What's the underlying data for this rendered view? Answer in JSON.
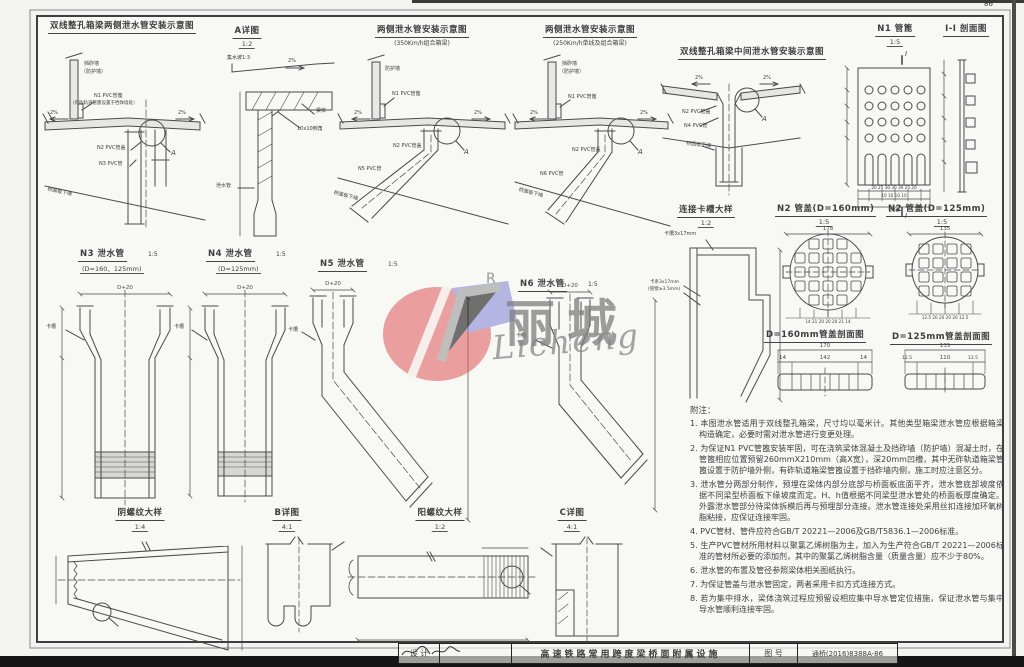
{
  "page": {
    "number": "86"
  },
  "common": {
    "slope": "2%",
    "detail_a": "A",
    "cover_label": "N2 PVC管盖",
    "grate_label": "N1 PVC管篦",
    "soffit_label": "桥面板下缘",
    "notch_label": "卡槽",
    "dim_d20": "D+20",
    "section_i": "I"
  },
  "figures": {
    "f1": {
      "title": "双线整孔箱梁两侧泄水管安装示意图",
      "wall1": "挡砟墙",
      "wall2": "（防护墙）",
      "grate_note": "（有砟轨道管篦设置于挡砟墙处）",
      "pipe": "N3 PVC管"
    },
    "f2": {
      "title": "A详图",
      "scale": "1:2",
      "slope_note": "集水坡1:3",
      "body": "梁体",
      "chamfer": "10x10倒角",
      "pipe": "泄水管"
    },
    "f3": {
      "title": "两侧泄水管安装示意图",
      "subtitle": "(350Km/h组合箱梁)",
      "wall": "防护墙",
      "pipe": "N5 PVC管"
    },
    "f4": {
      "title": "两侧泄水管安装示意图",
      "subtitle": "(250Km/h单线及组合箱梁)",
      "wall1": "挡砟墙",
      "wall2": "（防护墙）",
      "pipe": "N6 PVC管"
    },
    "f5": {
      "title": "双线整孔箱梁中间泄水管安装示意图",
      "pipe": "N4 PVC管"
    },
    "f6": {
      "title": "N1 管篦",
      "scale": "1:5",
      "dims_row1": "20 25 30 30 30 25 20",
      "dims_row2": "10 10 10 10",
      "dim_total": "200"
    },
    "f7": {
      "title": "I-I 剖面图"
    },
    "f8": {
      "title": "N3 泄水管",
      "scale": "1:5",
      "subtitle": "(D=160、125mm)"
    },
    "f9": {
      "title": "N4 泄水管",
      "scale": "1:5",
      "subtitle": "(D=125mm)"
    },
    "f10": {
      "title": "N5 泄水管",
      "scale": "1:5"
    },
    "f11": {
      "title": "N6 泄水管",
      "scale": "1:5"
    },
    "f12": {
      "title": "连接卡槽大样",
      "scale": "1:2",
      "label_top": "卡槽3x17mm",
      "label_left1": "卡条3x17mm",
      "label_left2": "(管壁≥3.5mm)"
    },
    "f13": {
      "title": "N2 管盖(D=160mm)",
      "scale": "1:5",
      "dim_top": "178",
      "dim_bottom": "14 21 20 20 20 21 14"
    },
    "f14": {
      "title": "N2 管盖(D=125mm)",
      "scale": "1:5",
      "dim_top": "135",
      "dim_bottom": "12.5 20 20 20 20 12.5"
    },
    "f15": {
      "title": "D=160mm管盖剖面图",
      "dim_total": "170",
      "dim_inner": "142",
      "dim_side": "14"
    },
    "f16": {
      "title": "D=125mm管盖剖面图",
      "dim_total": "135",
      "dim_inner": "110",
      "dim_side": "12.5"
    },
    "f17": {
      "title": "阴螺纹大样",
      "scale": "1:4"
    },
    "f18": {
      "title": "B详图",
      "scale": "4:1"
    },
    "f19": {
      "title": "阳螺纹大样",
      "scale": "1:2"
    },
    "f20": {
      "title": "C详图",
      "scale": "4:1"
    }
  },
  "watermark": {
    "cn": "丽城",
    "en": "Licheng",
    "r_mark": "R"
  },
  "notes": {
    "title": "附注：",
    "items": [
      "1. 本图泄水管适用于双线整孔箱梁，尺寸均以毫米计。其他类型箱梁泄水管应根据箱梁构造确定，必要时需对泄水管进行变更处理。",
      "2. 为保证N1 PVC管篦安装牢固，可在浇筑梁体混凝土及挡砟墙（防护墙）混凝土时，在管篦相应位置预留260mmX210mm（高X宽），深20mm凹槽，其中无砟轨道箱梁管篦设置于防护墙外侧，有砟轨道箱梁管篦设置于挡砟墙内侧，施工时应注意区分。",
      "3. 泄水管分两部分制作，预埋在梁体内部分底部与桥面板底面平齐，泄水管底部坡度依据不同梁型桥面板下缘坡度而定。H、h值根据不同梁型泄水管处的桥面板厚度确定。外露泄水管部分待梁体拆模后再与预埋部分连接。泄水管连接处采用丝扣连接加环氧树脂粘接，应保证连接牢固。",
      "4. PVC管材、管件应符合GB/T 20221—2006及GB/T5836.1—2006标准。",
      "5. 生产PVC管材所用材料以聚氯乙烯树脂为主，加入为生产符合GB/T 20221—2006标准的管材所必要的添加剂，其中的聚氯乙烯树脂含量（质量含量）应不少于80%。",
      "6. 泄水管的布置及管径参照梁体相关图纸执行。",
      "7. 为保证管盖与泄水管固定，两者采用卡扣方式连接方式。",
      "8. 若为集中排水，梁体浇筑过程应预留设相应集中导水管定位措施，保证泄水管与集中导水管顺利连接牢固。"
    ]
  },
  "titlebar": {
    "design_label": "设 计",
    "project": "高速铁路常用跨度梁桥面附属设施",
    "no_label": "图 号",
    "no_value": "通桥(2016)8388A-86"
  }
}
